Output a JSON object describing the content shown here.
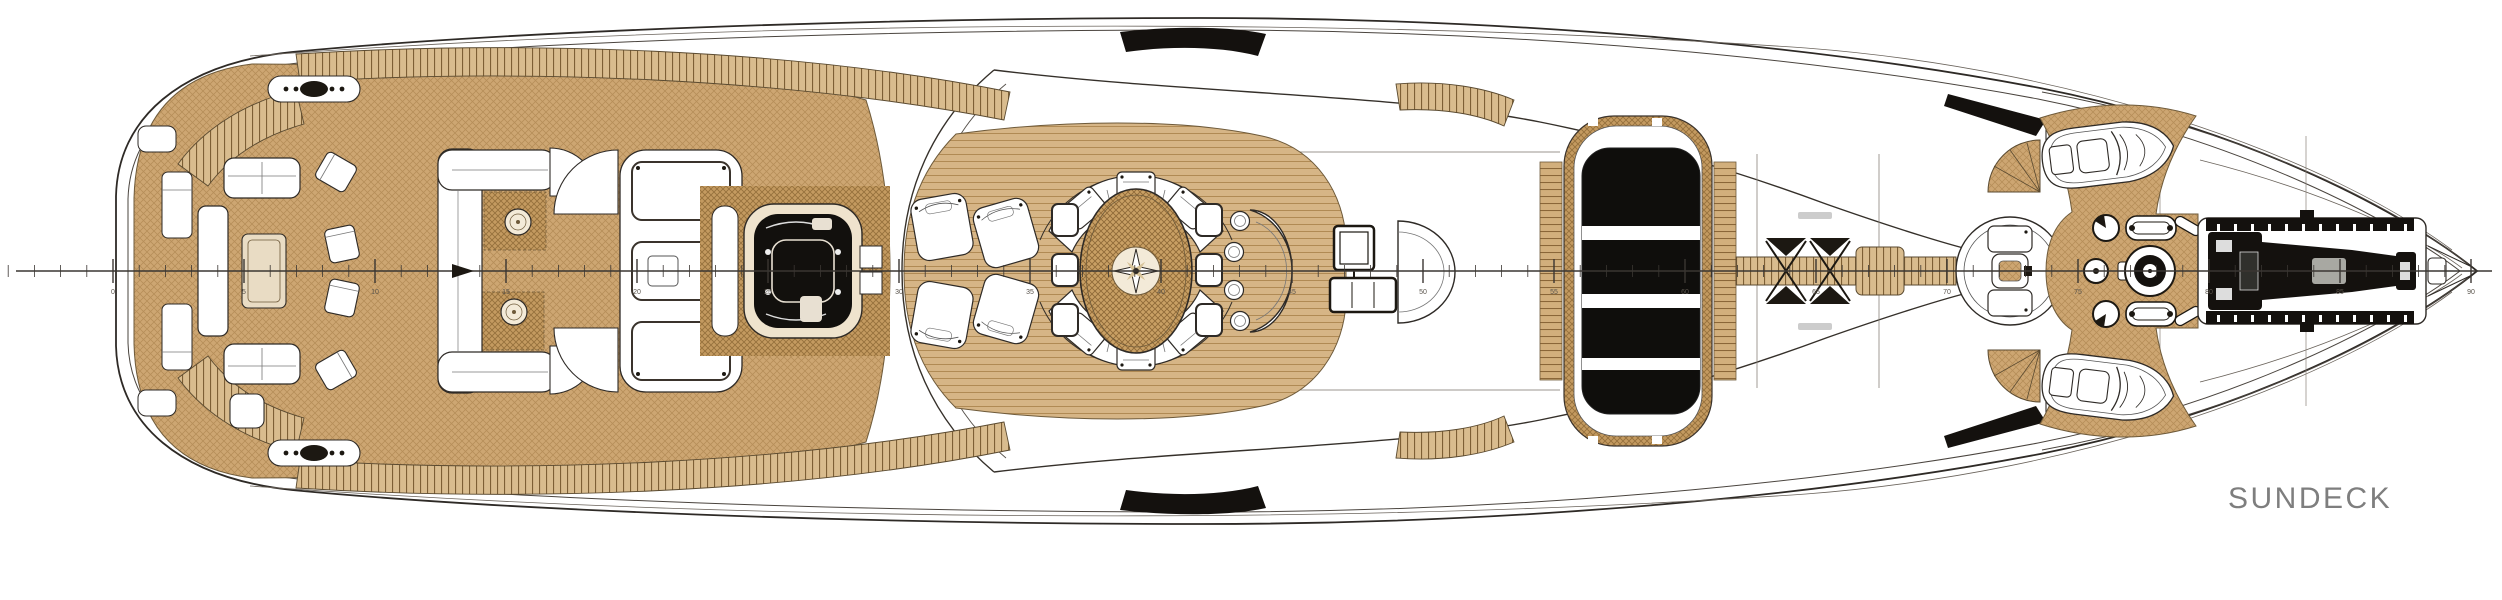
{
  "title": {
    "label": "SUNDECK",
    "color": "#7e7e7e"
  },
  "drawing": {
    "type": "yacht-general-arrangement-plan",
    "deck": "SUNDECK",
    "orientation": "bow-right",
    "colors": {
      "paper": "#ffffff",
      "line": "#2e2a26",
      "teak": "#cda672",
      "teak_dark": "#c49a60",
      "tread": "#d9bc8e",
      "glass": "#0f0e0c",
      "dark_equipment": "#14110e",
      "label": "#7e7e7e"
    },
    "ruler": {
      "y": 271,
      "frame0_x": 113,
      "spacing": 26.2,
      "start_frame": -4,
      "end_frame": 90,
      "label_step": 5,
      "labels": [
        "0",
        "5",
        "10",
        "15",
        "20",
        "25",
        "30",
        "35",
        "40",
        "45",
        "50",
        "55",
        "60",
        "65",
        "70",
        "75",
        "80",
        "85",
        "90"
      ]
    },
    "features": [
      "aft-stairs",
      "aft-lounge-sofas",
      "coffee-table",
      "director-chairs",
      "corner-sofa",
      "round-tables",
      "sunpad-three-cushions",
      "jacuzzi",
      "chaise-lounges",
      "dining-table-compass-rose",
      "dining-chairs",
      "arc-benches",
      "bar-crescent",
      "bar-stools",
      "tv-cabinet",
      "semicircular-seat",
      "skylight-glazing",
      "catwalk",
      "rigging-cross-marks",
      "observation-circle-platform",
      "fan-stairs",
      "tender-boats",
      "windlass-capstans",
      "bow-crane",
      "bow-pulpit"
    ]
  }
}
